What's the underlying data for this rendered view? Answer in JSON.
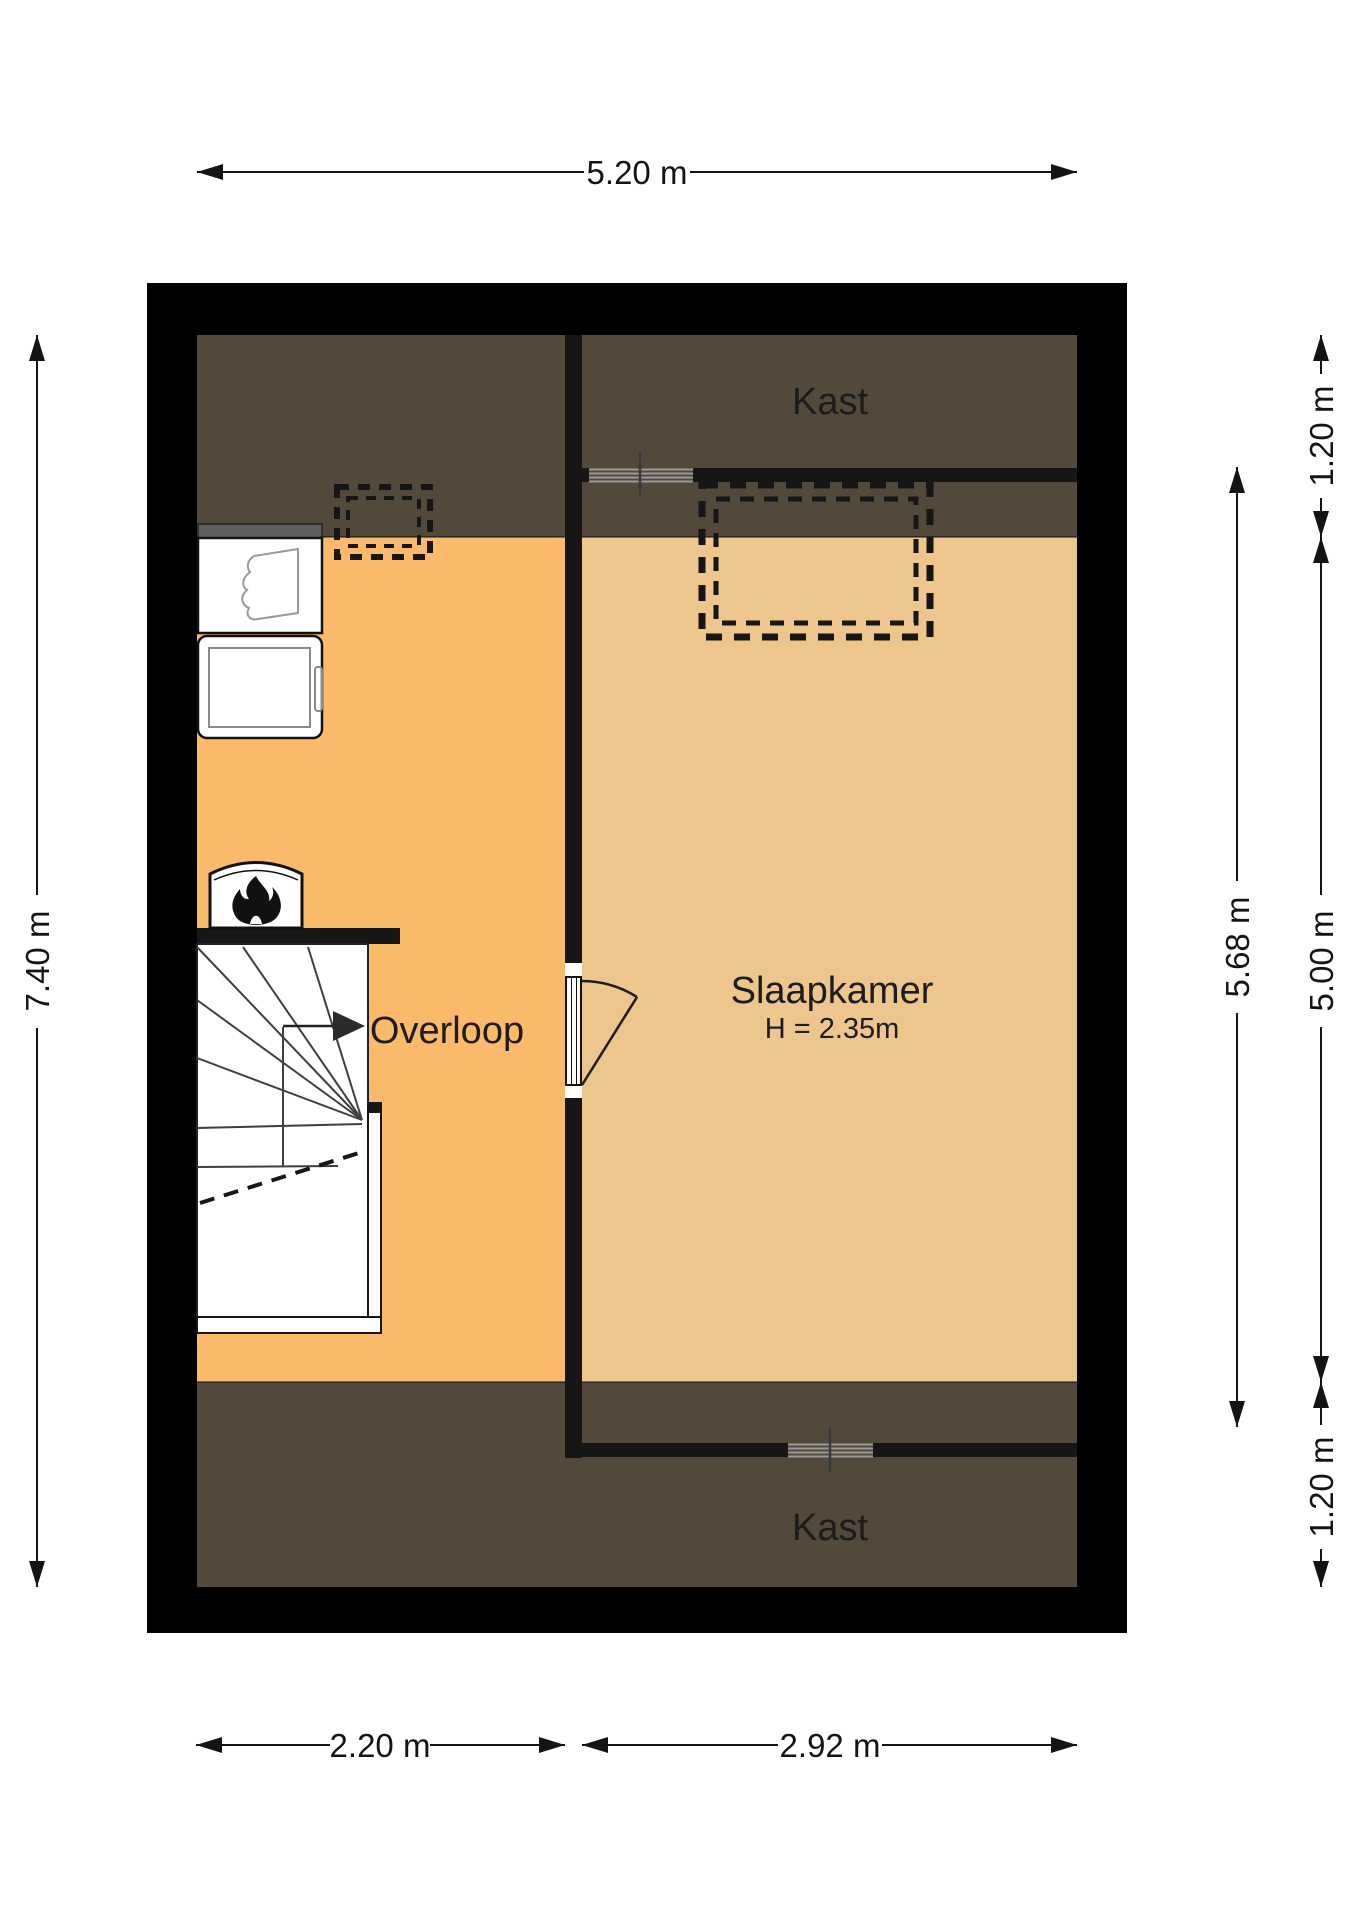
{
  "plan": {
    "title": "attic-floorplan",
    "rooms": {
      "kast_top": {
        "label": "Kast"
      },
      "slaapkamer": {
        "label": "Slaapkamer",
        "height_note": "H = 2.35m"
      },
      "overloop": {
        "label": "Overloop"
      },
      "kast_bottom": {
        "label": "Kast"
      }
    },
    "dimensions": {
      "width_total": "5.20 m",
      "height_total": "7.40 m",
      "right_top": "1.20 m",
      "bedroom_inner": "5.68 m",
      "right_middle": "5.00 m",
      "right_bottom": "1.20 m",
      "bottom_left": "2.20 m",
      "bottom_right": "2.92 m"
    },
    "colors": {
      "outer_wall": "#000000",
      "inner_wall": "#161616",
      "attic_slope_zone": "#53493A",
      "overloop_floor": "#FBBA6B",
      "slaapkamer_floor": "#ECC68C",
      "counter_gray": "#5E5E5E",
      "fixture_white": "#FFFFFF"
    },
    "fixtures": {
      "sink": "sink",
      "washing_machine": "washing-machine",
      "boiler": "boiler-with-flame",
      "stairs": "winder-staircase",
      "door": "swing-door",
      "sliding_door_top": "sliding-door",
      "sliding_door_bottom": "sliding-door",
      "dormer_large": "dashed-dormer-outline",
      "dormer_small": "dashed-roof-window-outline"
    }
  }
}
